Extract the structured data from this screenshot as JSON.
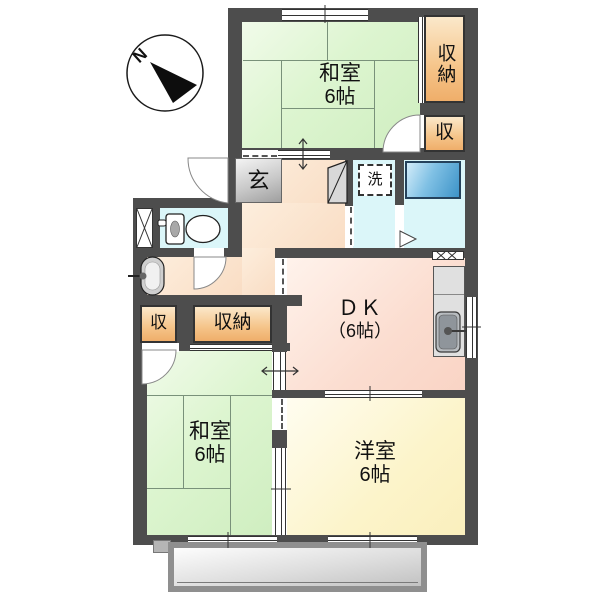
{
  "compass": {
    "label": "N"
  },
  "rooms": {
    "washitsu_top": {
      "name": "和室",
      "size": "6帖"
    },
    "washitsu_bottom": {
      "name": "和室",
      "size": "6帖"
    },
    "youshitsu": {
      "name": "洋室",
      "size": "6帖"
    },
    "dk": {
      "name": "ＤＫ",
      "size": "（6帖）"
    }
  },
  "storage": {
    "closet_top": "収納",
    "storage_top": "収",
    "storage_bottom": "収",
    "closet_bottom": "収納"
  },
  "fixtures": {
    "entrance": "玄",
    "laundry": "洗"
  },
  "palette": {
    "wall": "#4d4d4d",
    "tatami_green": "#ddf5d0",
    "storage_orange": "#f5c489",
    "dk_pink": "#fbddd0",
    "western_yellow": "#fcf4ca",
    "hall_peach": "#f9ddc4",
    "wet_area_cyan": "#dbf6f9",
    "bathtub_blue": "#4a9cd2",
    "balcony_gray": "#c6c6c6"
  }
}
